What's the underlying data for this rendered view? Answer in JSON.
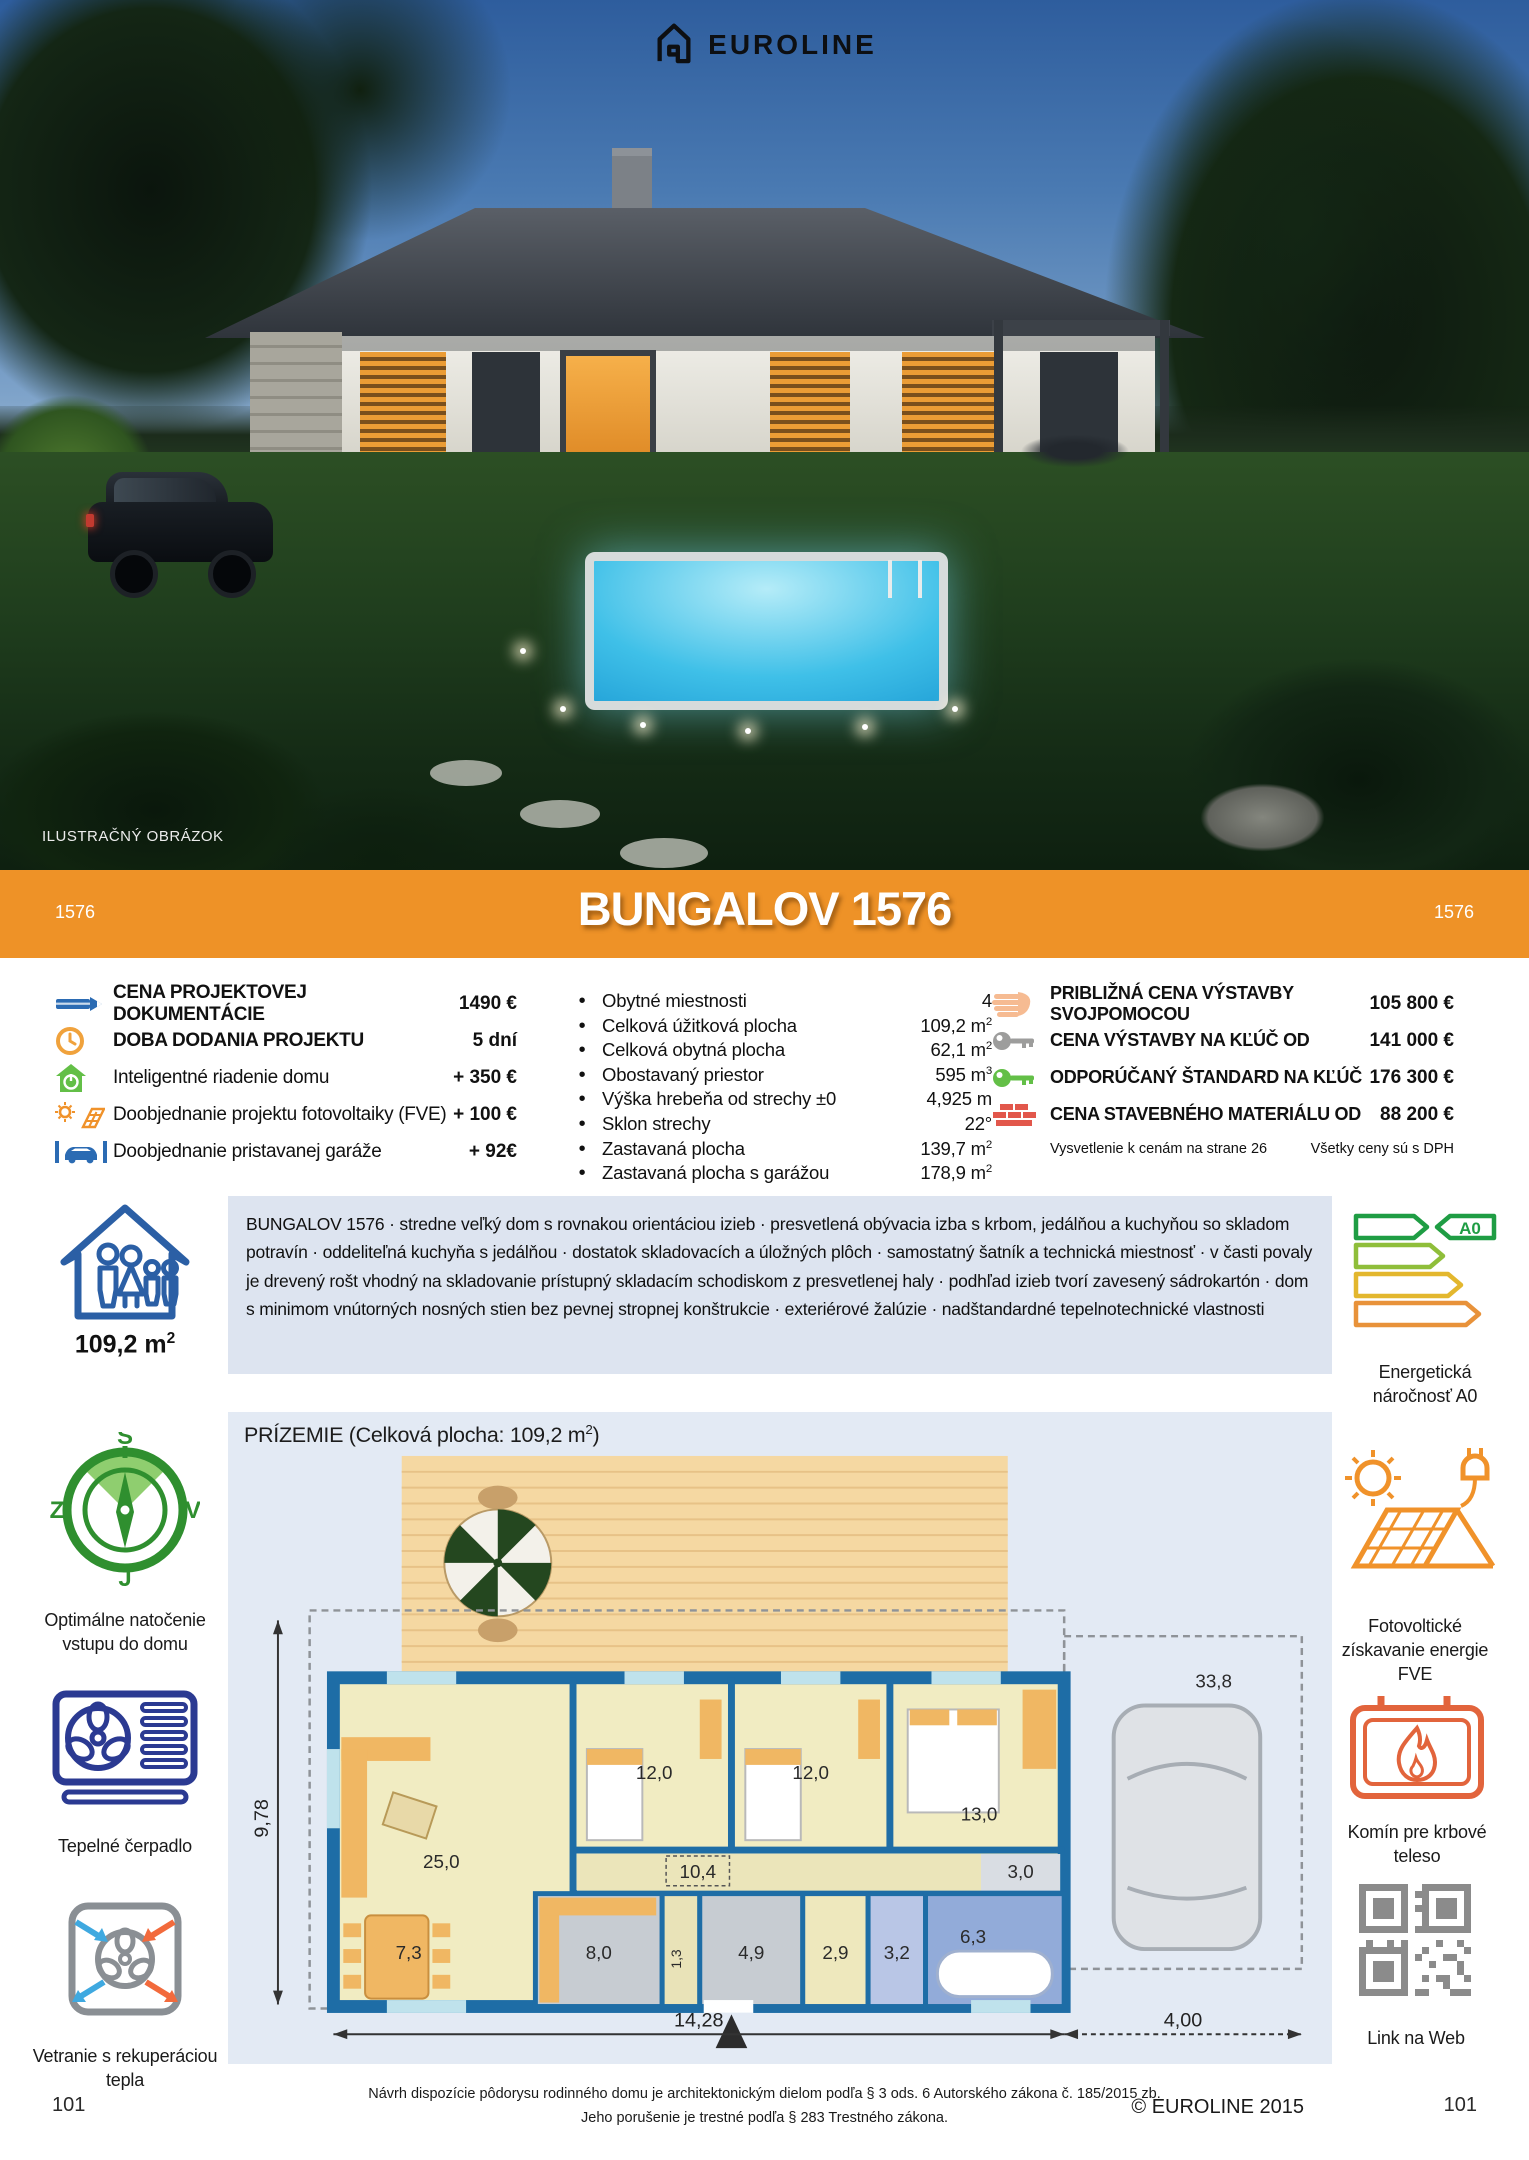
{
  "brand": {
    "logo": "EUROLINE"
  },
  "photo": {
    "caption": "ILUSTRAČNÝ OBRÁZOK"
  },
  "banner": {
    "code_left": "1576",
    "title": "BUNGALOV 1576",
    "code_right": "1576",
    "color": "#ee9227"
  },
  "order": {
    "items": [
      {
        "icon": "pencil-icon",
        "label": "CENA PROJEKTOVEJ DOKUMENTÁCIE",
        "value": "1490 €"
      },
      {
        "icon": "clock-icon",
        "label": "DOBA DODANIA PROJEKTU",
        "value": "5 dní"
      },
      {
        "icon": "smart-home-icon",
        "label": "Inteligentné riadenie domu",
        "value": "+ 350 €"
      },
      {
        "icon": "solar-icon",
        "label": "Doobjednanie projektu fotovoltaiky (FVE)",
        "value": "+ 100 €"
      },
      {
        "icon": "garage-car-icon",
        "label": "Doobjednanie pristavanej garáže",
        "value": "+ 92€"
      }
    ]
  },
  "specs": {
    "items": [
      {
        "label": "Obytné miestnosti",
        "value": "4",
        "sup": ""
      },
      {
        "label": "Celková úžitková plocha",
        "value": "109,2 m",
        "sup": "2"
      },
      {
        "label": "Celková obytná plocha",
        "value": "62,1 m",
        "sup": "2"
      },
      {
        "label": "Obostavaný priestor",
        "value": "595 m",
        "sup": "3"
      },
      {
        "label": "Výška hrebeňa od strechy ±0",
        "value": "4,925 m",
        "sup": ""
      },
      {
        "label": "Sklon strechy",
        "value": "22°",
        "sup": ""
      },
      {
        "label": "Zastavaná plocha",
        "value": "139,7 m",
        "sup": "2"
      },
      {
        "label": "Zastavaná plocha s garážou",
        "value": "178,9 m",
        "sup": "2"
      }
    ]
  },
  "build_prices": {
    "items": [
      {
        "icon": "hand-icon",
        "label": "PRIBLIŽNÁ CENA VÝSTAVBY SVOJPOMOCOU",
        "value": "105 800 €"
      },
      {
        "icon": "key-gray-icon",
        "label": "CENA VÝSTAVBY NA KĽÚČ OD",
        "value": "141 000 €"
      },
      {
        "icon": "key-green-icon",
        "label": "ODPORÚČANÝ ŠTANDARD NA KĽÚČ",
        "value": "176 300 €"
      },
      {
        "icon": "bricks-icon",
        "label": "CENA STAVEBNÉHO MATERIÁLU OD",
        "value": "88 200 €"
      }
    ],
    "note_left": "Vysvetlenie k cenám na strane 26",
    "note_right": "Všetky ceny sú s DPH"
  },
  "description": "BUNGALOV 1576 · stredne veľký dom s rovnakou orientáciou izieb · presvetlená obývacia izba s krbom, jedálňou a kuchyňou so skladom potravín · oddeliteľná kuchyňa s jedálňou · dostatok skladovacích a úložných plôch · samostatný šatník a technická miestnosť · v časti povaly je drevený rošt vhodný na skladovanie prístupný skladacím schodiskom z presvetlenej haly · podhľad izieb tvorí zavesený sádrokartón · dom s minimom vnútorných nosných stien bez pevnej stropnej konštrukcie · exteriérové žalúzie · nadštandardné tepelnotechnické vlastnosti",
  "features_left": {
    "area": {
      "value": "109,2 m",
      "sup": "2"
    },
    "compass": {
      "caption": "Optimálne natočenie vstupu do domu",
      "north": "S",
      "east": "V",
      "south": "J",
      "west": "Z"
    },
    "heat_pump": {
      "caption": "Tepelné čerpadlo"
    },
    "ventilation": {
      "caption": "Vetranie s rekuperáciou tepla"
    }
  },
  "features_right": {
    "energy": {
      "caption": "Energetická náročnosť A0",
      "class_label": "A0"
    },
    "photovoltaic": {
      "caption": "Fotovoltické získavanie energie FVE"
    },
    "fireplace": {
      "caption": "Komín pre krbové teleso"
    },
    "qr": {
      "caption": "Link na Web"
    }
  },
  "floorplan": {
    "title_prefix": "PRÍZEMIE (Celková plocha: 109,2 m",
    "title_sup": "2",
    "title_suffix": ")",
    "rooms": [
      "25,0",
      "12,0",
      "12,0",
      "13,0",
      "10,4",
      "3,0",
      "7,3",
      "8,0",
      "1,3",
      "4,9",
      "2,9",
      "3,2",
      "6,3",
      "33,8"
    ],
    "dim_width": "14,28",
    "dim_garage": "4,00",
    "dim_depth": "9,78"
  },
  "footer": {
    "line1": "Návrh dispozície pôdorysu rodinného domu je architektonickým dielom podľa § 3 ods. 6 Autorského zákona č. 185/2015 zb.",
    "line2": "Jeho porušenie je trestné podľa § 283 Trestného zákona.",
    "copyright": "© EUROLINE 2015",
    "page_left": "101",
    "page_right": "101"
  }
}
